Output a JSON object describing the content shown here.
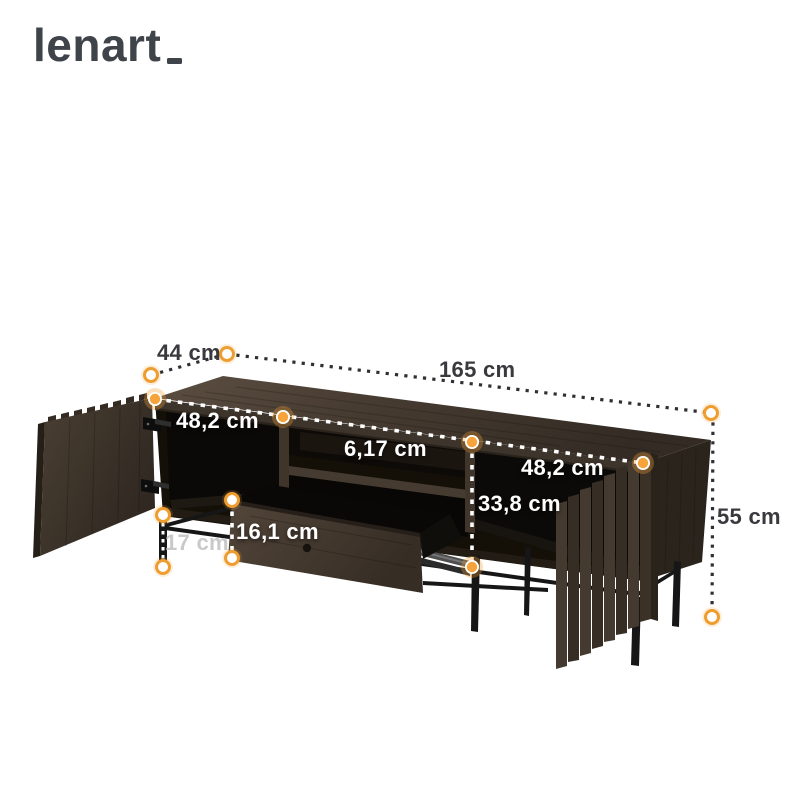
{
  "logo": {
    "text": "lenart"
  },
  "dimensions": {
    "depth": "44 cm",
    "width": "165 cm",
    "height": "55 cm",
    "left_section_width": "48,2 cm",
    "right_section_width": "48,2 cm",
    "niche_height": "6,17 cm",
    "interior_height": "33,8 cm",
    "drawer_front_height": "16,1 cm",
    "leg_clearance": "17 cm"
  },
  "colors": {
    "accent_orange": "#F2A23A",
    "measure_line_dark": "#303034",
    "label_dark": "#3A3A3E",
    "label_light": "#FFFFFF",
    "label_muted": "#C9C9C9",
    "wood_dark": "#43382D",
    "legs_black": "#161616",
    "logo_gray": "#3F434A"
  }
}
